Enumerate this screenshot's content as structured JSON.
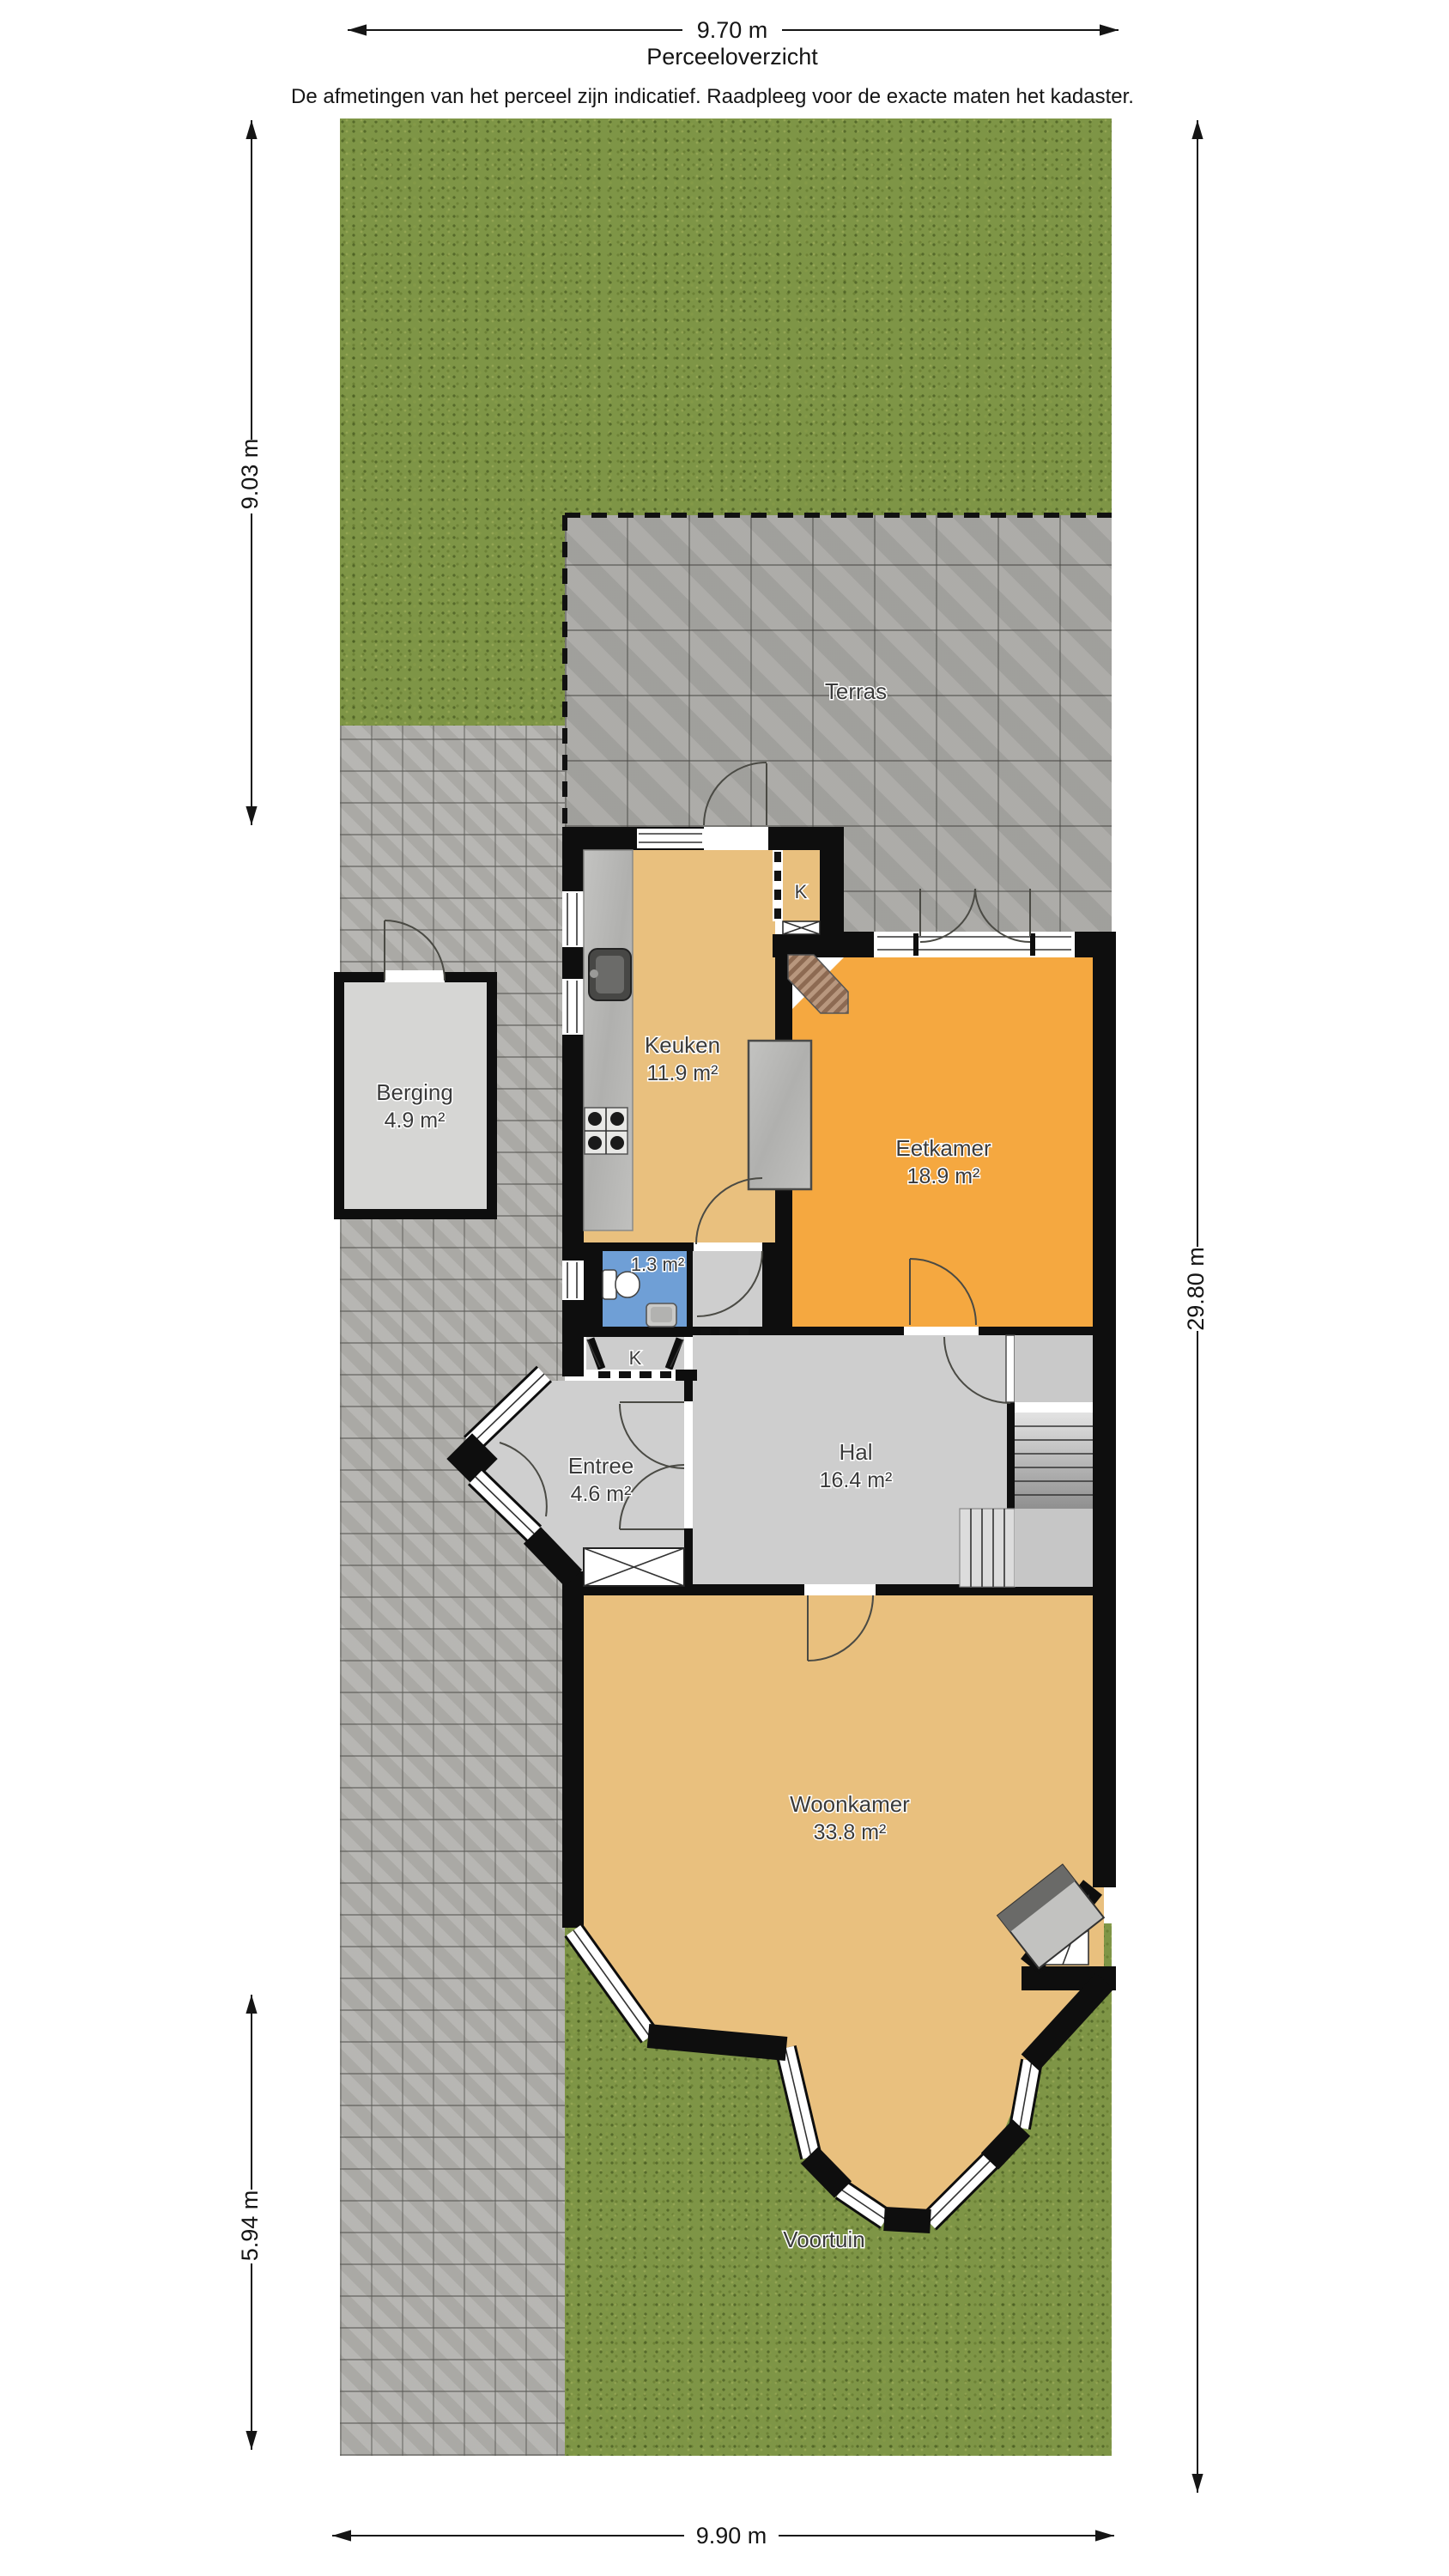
{
  "header": {
    "plan_title": "Perceeloverzicht",
    "disclaimer": "De afmetingen van het perceel zijn indicatief. Raadpleeg voor de exacte maten het kadaster."
  },
  "dimensions": {
    "top": "9.70 m",
    "left_upper": "9.03 m",
    "left_lower": "5.94 m",
    "right": "29.80 m",
    "bottom": "9.90 m"
  },
  "outdoor": {
    "terras": "Terras",
    "voortuin": "Voortuin"
  },
  "rooms": {
    "berging": {
      "name": "Berging",
      "area": "4.9 m²"
    },
    "keuken": {
      "name": "Keuken",
      "area": "11.9 m²"
    },
    "eetkamer": {
      "name": "Eetkamer",
      "area": "18.9 m²"
    },
    "toilet": {
      "area": "1.3 m²"
    },
    "entree": {
      "name": "Entree",
      "area": "4.6 m²"
    },
    "hal": {
      "name": "Hal",
      "area": "16.4 m²"
    },
    "woonkamer": {
      "name": "Woonkamer",
      "area": "33.8 m²"
    },
    "closet_keuken": {
      "label": "K"
    },
    "closet_hal": {
      "label": "K"
    }
  },
  "colors": {
    "wall": "#0e0e0e",
    "grass": "#7e9546",
    "driveway": "#b3b2ae",
    "terras": "#a9a8a4",
    "floor_wood": "#e9c07e",
    "floor_eetkamer": "#f5a840",
    "floor_hall": "#cecece",
    "floor_toilet": "#6f9fd6",
    "floor_berging": "#d6d6d4"
  }
}
